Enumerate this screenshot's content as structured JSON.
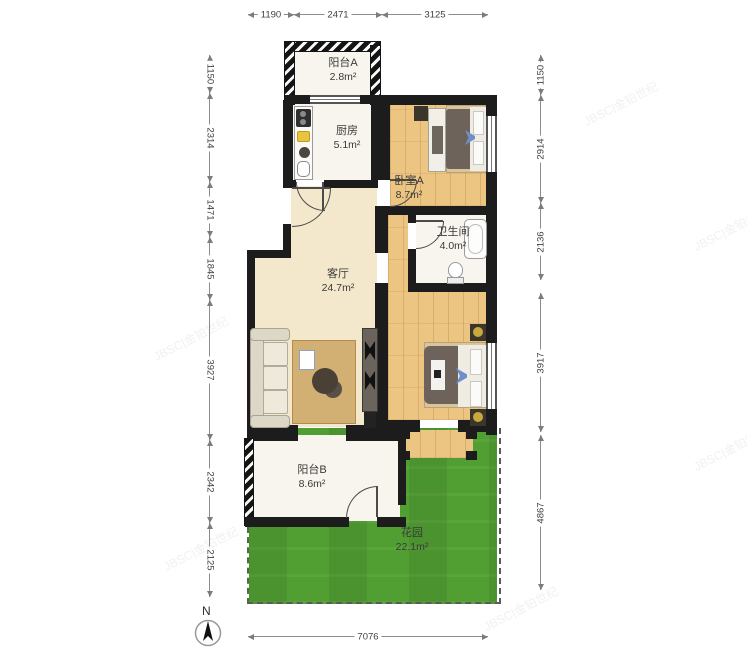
{
  "watermark": "JBSC|金铂世纪",
  "compass": {
    "label": "N"
  },
  "rooms": {
    "balcony_a": {
      "name": "阳台A",
      "area": "2.8m²"
    },
    "kitchen": {
      "name": "厨房",
      "area": "5.1m²"
    },
    "bedroom_a": {
      "name": "卧室A",
      "area": "8.7m²"
    },
    "bathroom": {
      "name": "卫生间",
      "area": "4.0m²"
    },
    "living_room": {
      "name": "客厅",
      "area": "24.7m²"
    },
    "balcony_b": {
      "name": "阳台B",
      "area": "8.6m²"
    },
    "garden": {
      "name": "花园",
      "area": "22.1m²"
    }
  },
  "dimensions": {
    "top": [
      "1190",
      "2471",
      "3125"
    ],
    "left": [
      "1150",
      "2314",
      "1471",
      "1845",
      "3927",
      "2342",
      "2125"
    ],
    "right": [
      "1150",
      "2914",
      "2136",
      "3917",
      "4867"
    ],
    "bottom": [
      "7076"
    ]
  }
}
